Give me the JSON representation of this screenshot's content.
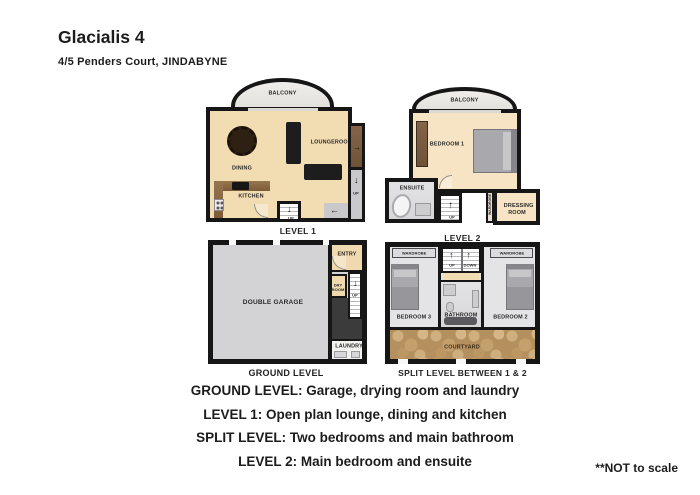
{
  "header": {
    "title": "Glacialis 4",
    "subtitle": "4/5 Penders Court, JINDABYNE"
  },
  "icons": {
    "up_arrow": "↑",
    "down_arrow": "↓",
    "left_arrow": "←",
    "right_arrow": "→"
  },
  "plans": {
    "level1": {
      "label": "LEVEL 1",
      "balcony": "BALCONY",
      "dining": "DINING",
      "loungeroom": "LOUNGEROOM",
      "kitchen": "KITCHEN",
      "up": "UP"
    },
    "level2": {
      "label": "LEVEL 2",
      "balcony": "BALCONY",
      "bedroom1": "BEDROOM 1",
      "ensuite": "ENSUITE",
      "wardrobe": "WARDROBE",
      "dressing_room": "DRESSING ROOM",
      "up": "UP"
    },
    "ground": {
      "label": "GROUND LEVEL",
      "double_garage": "DOUBLE GARAGE",
      "entry": "ENTRY",
      "dry_room": "DRY ROOM",
      "laundry": "LAUNDRY",
      "up": "UP"
    },
    "split": {
      "label": "SPLIT LEVEL BETWEEN 1 & 2",
      "bedroom3": "BEDROOM 3",
      "bathroom": "BATHROOM",
      "bedroom2": "BEDROOM 2",
      "courtyard": "COURTYARD",
      "wardrobe_left": "WARDROBE",
      "wardrobe_right": "WARDROBE",
      "up": "UP",
      "down": "DOWN"
    }
  },
  "captions": [
    "GROUND LEVEL: Garage, drying room and laundry",
    "LEVEL 1: Open plan lounge, dining and kitchen",
    "SPLIT LEVEL: Two bedrooms and main bathroom",
    "LEVEL 2: Main bedroom and ensuite"
  ],
  "footnote": "**NOT to scale",
  "colors": {
    "wall": "#161616",
    "floor_tan": "#f2dcb2",
    "floor_cream": "#f6e4c4",
    "floor_gray": "#d3d3d5",
    "bedroom_gray": "#e4e4e6",
    "courtyard_stone": "#b5905f"
  }
}
